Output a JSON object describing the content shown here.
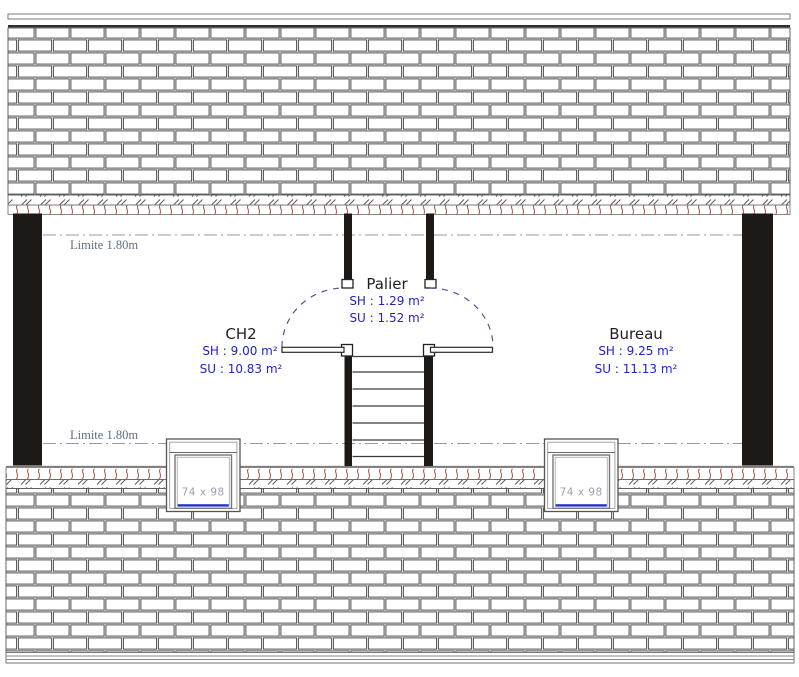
{
  "rooms": {
    "ch2": {
      "name": "CH2",
      "sh": "SH : 9.00 m²",
      "su": "SU : 10.83 m²"
    },
    "palier": {
      "name": "Palier",
      "sh": "SH : 1.29 m²",
      "su": "SU : 1.52 m²"
    },
    "bureau": {
      "name": "Bureau",
      "sh": "SH : 9.25 m²",
      "su": "SU : 11.13 m²"
    }
  },
  "limits": {
    "top": "Limite 1.80m",
    "bottom": "Limite 1.80m"
  },
  "windows": {
    "left": {
      "label": "74 x 98"
    },
    "right": {
      "label": "74 x 98"
    }
  },
  "colors": {
    "area_text_blue": "#2222cd",
    "room_text": "#1f1f1f",
    "limit_text": "#5f6e80",
    "window_text": "#98a1ad",
    "tile_red": "#b4604f",
    "window_sill_blue": "#2533cc",
    "wall_black": "#1d1916",
    "door_arc_blue": "#5050a0"
  }
}
